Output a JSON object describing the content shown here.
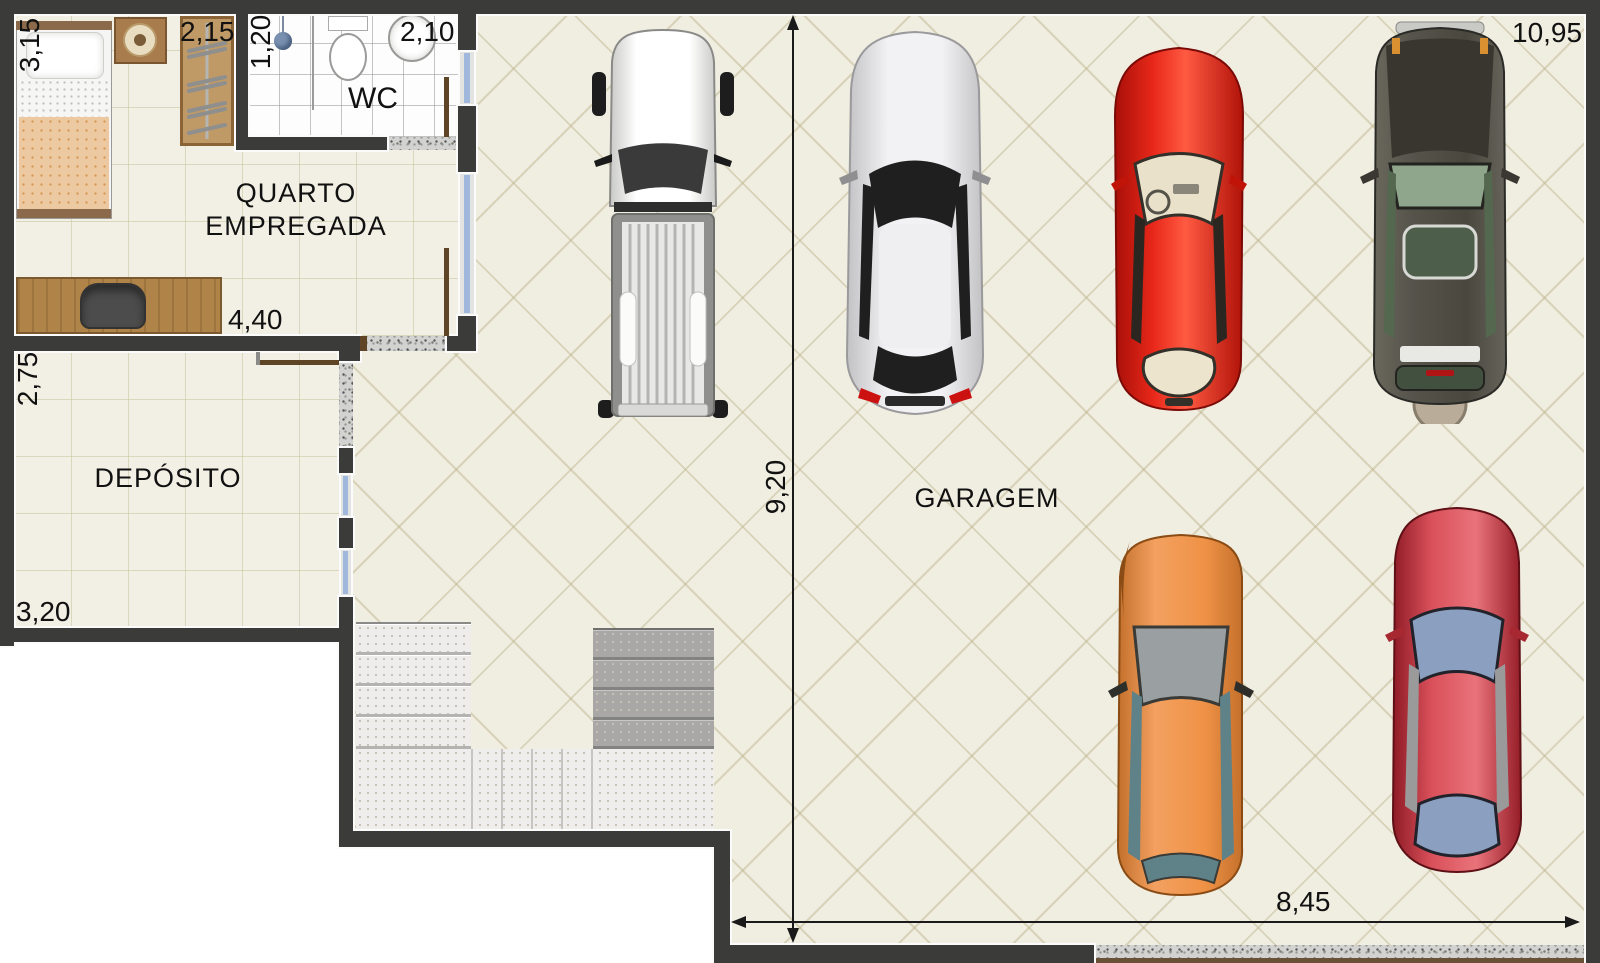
{
  "rooms": {
    "quarto_line1": "QUARTO",
    "quarto_line2": "EMPREGADA",
    "wc": "WC",
    "deposito": "DEPÓSITO",
    "garagem": "GARAGEM"
  },
  "dimensions": {
    "bed_wall": "3,15",
    "wardrobe_wall": "2,15",
    "wc_width": "1,20",
    "wc_length": "2,10",
    "quarto_width": "4,40",
    "deposito_depth": "2,75",
    "deposito_width": "3,20",
    "garage_depth": "9,20",
    "garage_width_top": "10,95",
    "garage_width_bottom": "8,45"
  },
  "colors": {
    "wall": "#3b3b39",
    "wall_outline": "#fbfbfb",
    "garage_floor": "#f0ede1",
    "room_floor": "#f2f0e4",
    "wc_floor": "#fdfdfd",
    "window_glass": "#9fb8dc",
    "door_wood": "#5f4426",
    "granite_threshold": "#d2d2d0",
    "blanket": "#ecc9a0",
    "furniture_wood": "#b08448"
  },
  "cars": [
    {
      "name": "white-pickup-truck",
      "body_color": "#f2f2f0"
    },
    {
      "name": "silver-sedan",
      "body_color": "#e4e4e6"
    },
    {
      "name": "red-sports-car",
      "body_color": "#d42418"
    },
    {
      "name": "dark-green-suv",
      "body_color": "#4c4c42"
    },
    {
      "name": "orange-suv",
      "body_color": "#e8913f"
    },
    {
      "name": "red-sedan",
      "body_color": "#bb2e3c"
    }
  ]
}
